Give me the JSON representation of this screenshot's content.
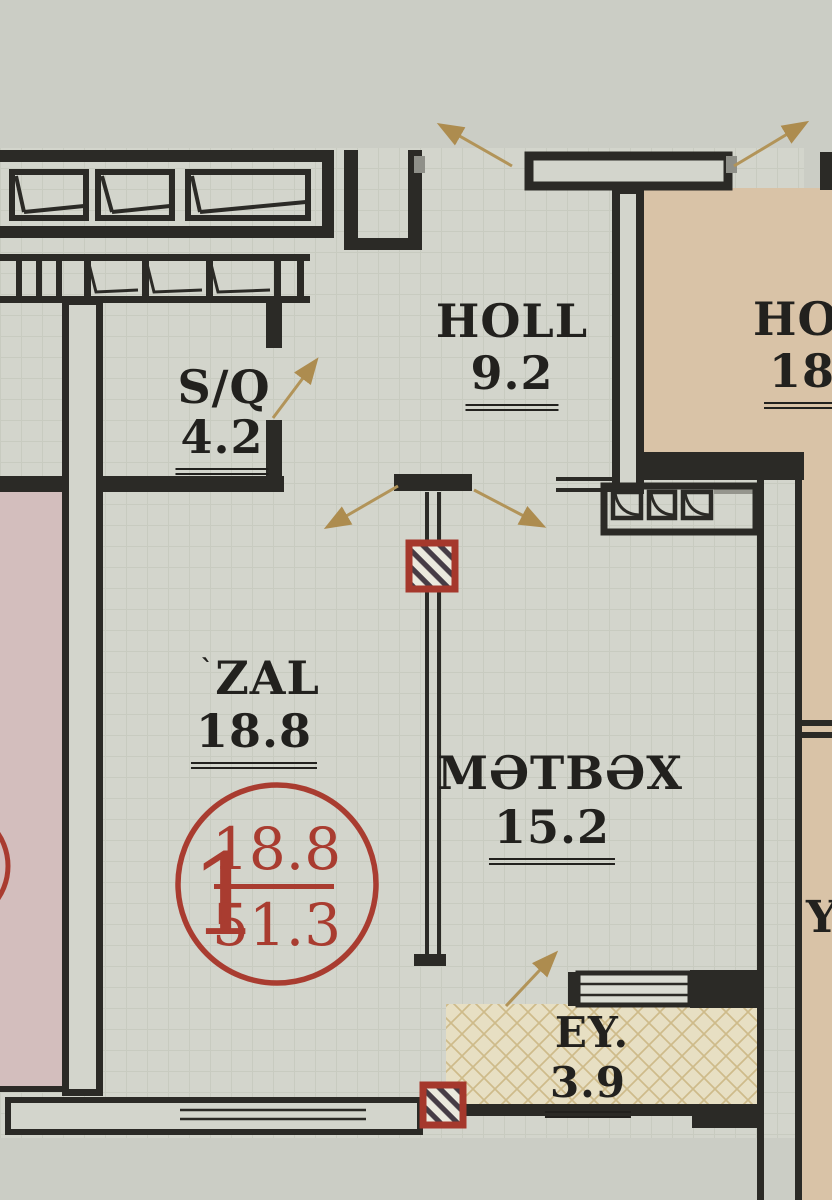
{
  "document": {
    "kind": "apartment-floor-plan"
  },
  "rooms": {
    "sq": {
      "label": "S/Q",
      "area": "4.2"
    },
    "holl": {
      "label": "HOLL",
      "area": "9.2"
    },
    "zal": {
      "label": "ZAL",
      "area": "18.8",
      "accent": "`"
    },
    "metbex": {
      "label": "MƏTBƏX",
      "area": "15.2"
    },
    "ey": {
      "label": "EY.",
      "area": "3.9"
    }
  },
  "neighbors": {
    "holl2": {
      "label": "HOLL",
      "area": "18.3"
    },
    "y_room": {
      "label": "Y"
    }
  },
  "stamp": {
    "number": "1",
    "numerator": "18.8",
    "denominator": "51.3"
  },
  "colors": {
    "wall": "#2b2a26",
    "floor": "#d3d5cc",
    "paper": "#cbcdc5",
    "neighbor_tan": "#d9c3a7",
    "neighbor_pink": "#d3bebd",
    "balcony_cream": "#e7dfc3",
    "stamp_red": "#a93c30",
    "door_arrow": "#b29459",
    "text": "#22211e"
  }
}
